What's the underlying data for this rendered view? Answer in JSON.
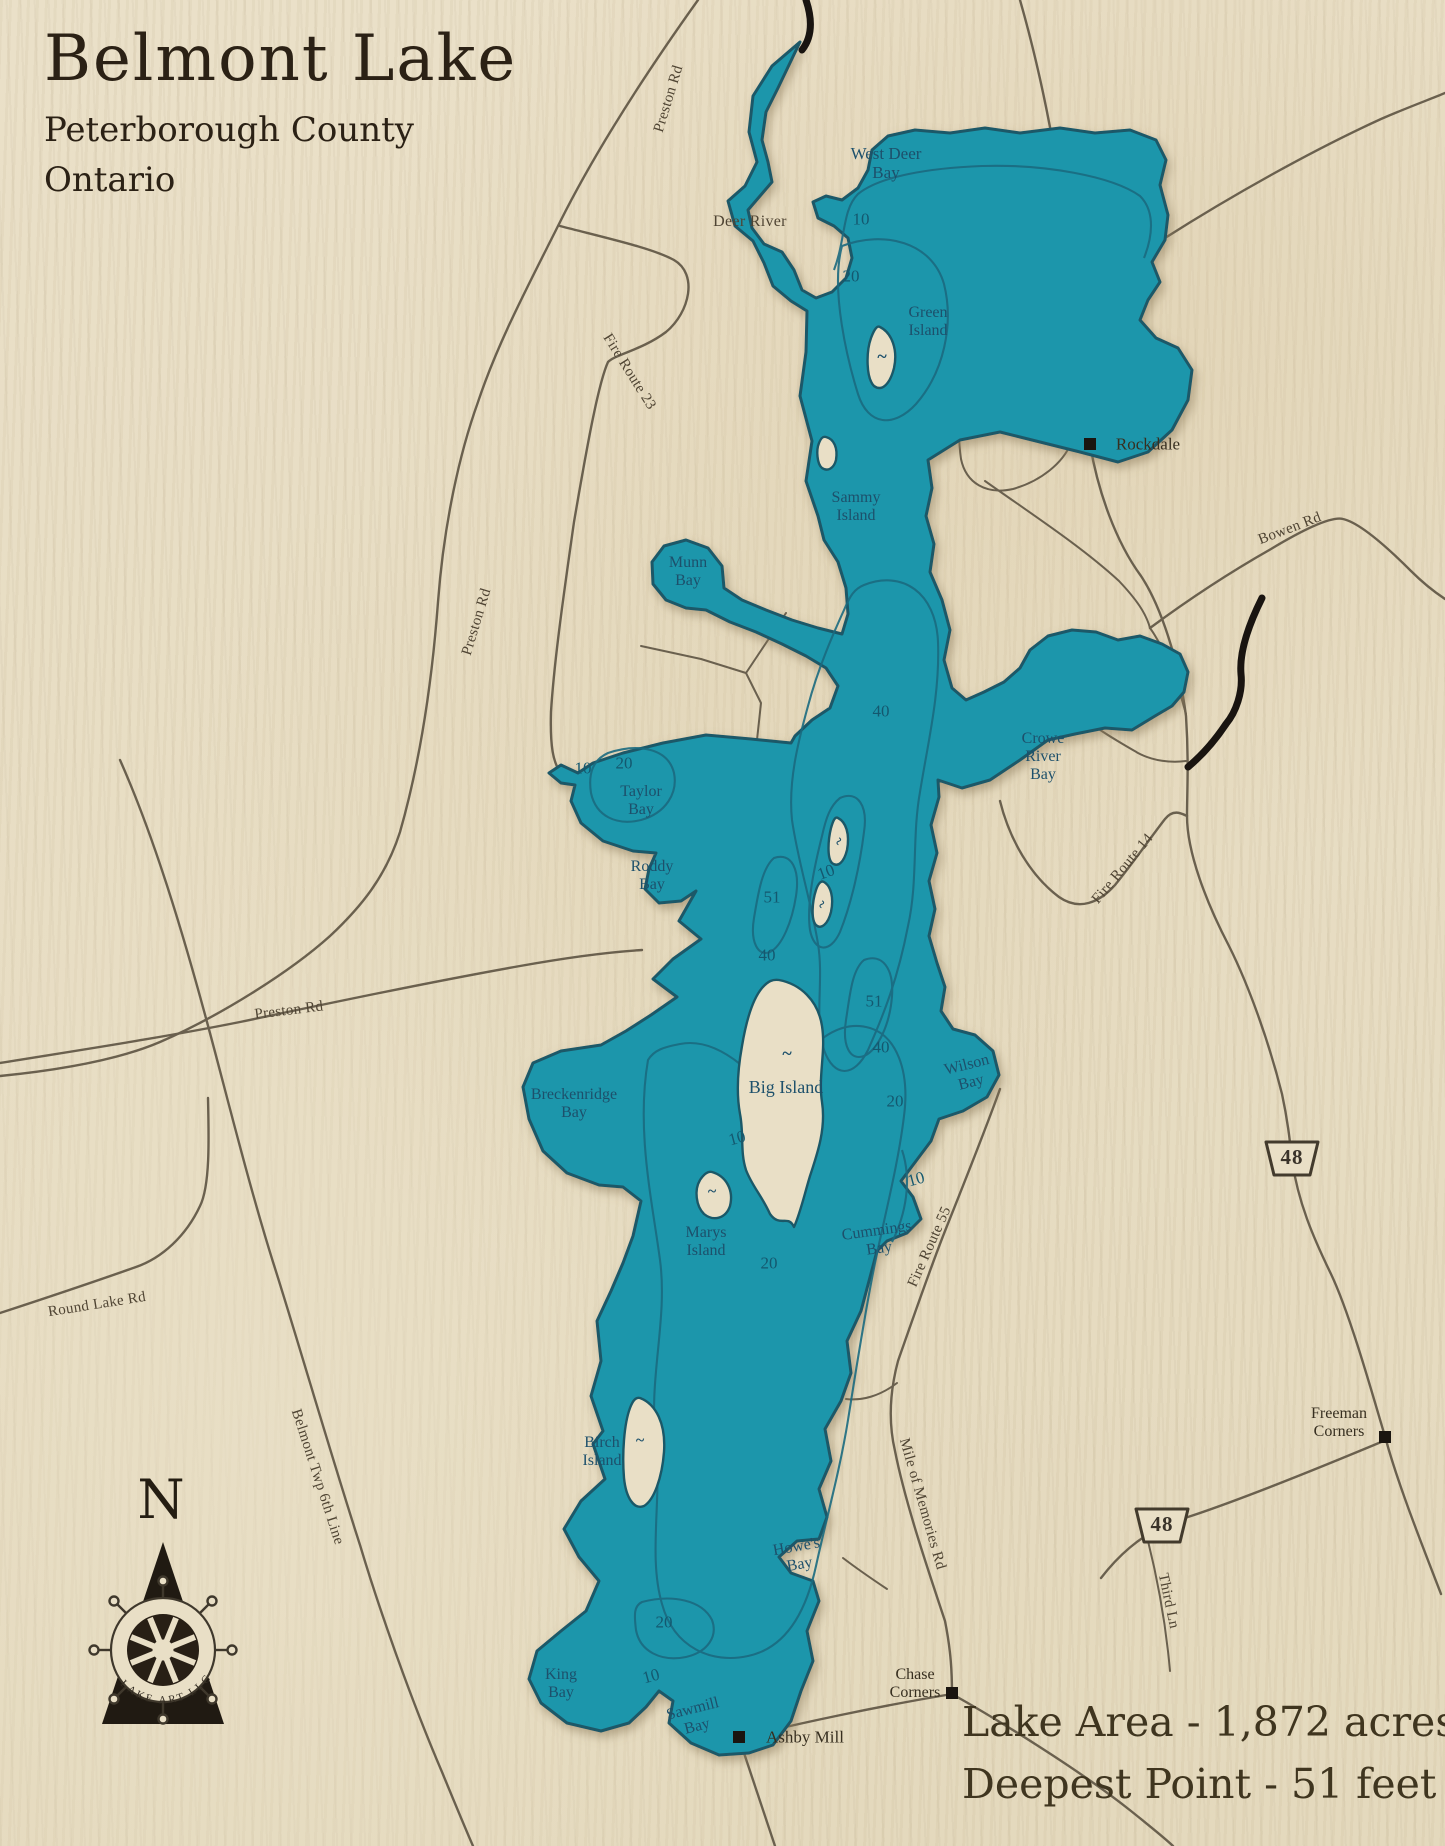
{
  "title": {
    "name": "Belmont Lake",
    "subtitle1": "Peterborough County",
    "subtitle2": "Ontario"
  },
  "stats": {
    "area": "Lake Area - 1,872 acres",
    "depth": "Deepest Point - 51 feet"
  },
  "compass": {
    "north": "N",
    "logo": "LAKE ART LLC"
  },
  "colors": {
    "wood": "#e9dfc6",
    "lake": "#1d96ab",
    "shore": "#1b5868",
    "contour": "#1b6a80",
    "road": "#6a604e",
    "ink": "#2b2115",
    "river_black": "#191410"
  },
  "map_labels": [
    {
      "id": "west-deer-bay",
      "kind": "water",
      "text": "West Deer\nBay",
      "x": 886,
      "y": 163,
      "rot": 0,
      "fs": 17
    },
    {
      "id": "green-island",
      "kind": "water",
      "text": "Green\nIsland",
      "x": 928,
      "y": 322,
      "rot": 0,
      "fs": 16
    },
    {
      "id": "sammy-island",
      "kind": "water",
      "text": "Sammy\nIsland",
      "x": 856,
      "y": 507,
      "rot": 0,
      "fs": 16
    },
    {
      "id": "munn-bay",
      "kind": "water",
      "text": "Munn\nBay",
      "x": 688,
      "y": 572,
      "rot": 0,
      "fs": 16
    },
    {
      "id": "taylor-bay",
      "kind": "water",
      "text": "Taylor\nBay",
      "x": 641,
      "y": 801,
      "rot": 0,
      "fs": 16
    },
    {
      "id": "roddy-bay",
      "kind": "water",
      "text": "Roddy\nBay",
      "x": 652,
      "y": 876,
      "rot": 0,
      "fs": 16
    },
    {
      "id": "crowe-river-bay",
      "kind": "water",
      "text": "Crowe\nRiver\nBay",
      "x": 1043,
      "y": 757,
      "rot": 0,
      "fs": 16
    },
    {
      "id": "wilson-bay",
      "kind": "water",
      "text": "Wilson\nBay",
      "x": 969,
      "y": 1074,
      "rot": -14,
      "fs": 16
    },
    {
      "id": "big-island",
      "kind": "water",
      "text": "Big Island",
      "x": 786,
      "y": 1087,
      "rot": 0,
      "fs": 18
    },
    {
      "id": "breckenridge-bay",
      "kind": "water",
      "text": "Breckenridge\nBay",
      "x": 574,
      "y": 1104,
      "rot": 0,
      "fs": 16
    },
    {
      "id": "marys-island",
      "kind": "water",
      "text": "Marys\nIsland",
      "x": 706,
      "y": 1242,
      "rot": 0,
      "fs": 16
    },
    {
      "id": "cummings-bay",
      "kind": "water",
      "text": "Cummings\nBay",
      "x": 878,
      "y": 1240,
      "rot": -8,
      "fs": 16
    },
    {
      "id": "birch-island",
      "kind": "water",
      "text": "Birch\nIsland",
      "x": 602,
      "y": 1452,
      "rot": 0,
      "fs": 16
    },
    {
      "id": "howes-bay",
      "kind": "water",
      "text": "Howe's\nBay",
      "x": 798,
      "y": 1556,
      "rot": -10,
      "fs": 16
    },
    {
      "id": "king-bay",
      "kind": "water",
      "text": "King\nBay",
      "x": 561,
      "y": 1684,
      "rot": 0,
      "fs": 16
    },
    {
      "id": "sawmill-bay",
      "kind": "water",
      "text": "Sawmill\nBay",
      "x": 695,
      "y": 1718,
      "rot": -14,
      "fs": 16
    },
    {
      "id": "tilde-green-island",
      "kind": "tilde",
      "text": "~",
      "x": 882,
      "y": 356,
      "rot": 0,
      "fs": 18
    },
    {
      "id": "tilde-big-island",
      "kind": "tilde",
      "text": "~",
      "x": 787,
      "y": 1053,
      "rot": 0,
      "fs": 18
    },
    {
      "id": "tilde-marys-island",
      "kind": "tilde",
      "text": "~",
      "x": 712,
      "y": 1192,
      "rot": 0,
      "fs": 16
    },
    {
      "id": "tilde-birch-island",
      "kind": "tilde",
      "text": "~",
      "x": 640,
      "y": 1441,
      "rot": 0,
      "fs": 16
    },
    {
      "id": "tilde-mid-island-a",
      "kind": "tilde",
      "text": "~",
      "x": 840,
      "y": 842,
      "rot": -60,
      "fs": 15
    },
    {
      "id": "tilde-mid-island-b",
      "kind": "tilde",
      "text": "~",
      "x": 823,
      "y": 905,
      "rot": -60,
      "fs": 15
    },
    {
      "id": "depth-10-westdeer",
      "kind": "depth",
      "text": "10",
      "x": 861,
      "y": 219,
      "rot": 0,
      "fs": 17
    },
    {
      "id": "depth-20-north",
      "kind": "depth",
      "text": "20",
      "x": 851,
      "y": 276,
      "rot": 0,
      "fs": 17
    },
    {
      "id": "depth-40-midnorth",
      "kind": "depth",
      "text": "40",
      "x": 881,
      "y": 711,
      "rot": 0,
      "fs": 17
    },
    {
      "id": "depth-20-taylor",
      "kind": "depth",
      "text": "20",
      "x": 624,
      "y": 763,
      "rot": 0,
      "fs": 17
    },
    {
      "id": "depth-10-taylor",
      "kind": "depth",
      "text": "10",
      "x": 583,
      "y": 768,
      "rot": 0,
      "fs": 17
    },
    {
      "id": "depth-51-west",
      "kind": "depth",
      "text": "51",
      "x": 772,
      "y": 897,
      "rot": 0,
      "fs": 17
    },
    {
      "id": "depth-10-islands",
      "kind": "depth",
      "text": "10",
      "x": 826,
      "y": 872,
      "rot": -20,
      "fs": 17
    },
    {
      "id": "depth-40-west",
      "kind": "depth",
      "text": "40",
      "x": 767,
      "y": 955,
      "rot": 0,
      "fs": 17
    },
    {
      "id": "depth-51-southeast",
      "kind": "depth",
      "text": "51",
      "x": 874,
      "y": 1001,
      "rot": 0,
      "fs": 17
    },
    {
      "id": "depth-40-south",
      "kind": "depth",
      "text": "40",
      "x": 881,
      "y": 1047,
      "rot": 0,
      "fs": 17
    },
    {
      "id": "depth-20-wilson",
      "kind": "depth",
      "text": "20",
      "x": 895,
      "y": 1101,
      "rot": 0,
      "fs": 17
    },
    {
      "id": "depth-10-bigisland",
      "kind": "depth",
      "text": "10",
      "x": 737,
      "y": 1138,
      "rot": -15,
      "fs": 17
    },
    {
      "id": "depth-10-cummings",
      "kind": "depth",
      "text": "10",
      "x": 916,
      "y": 1179,
      "rot": -15,
      "fs": 17
    },
    {
      "id": "depth-20-marys",
      "kind": "depth",
      "text": "20",
      "x": 769,
      "y": 1263,
      "rot": 0,
      "fs": 17
    },
    {
      "id": "depth-20-sawmill",
      "kind": "depth",
      "text": "20",
      "x": 664,
      "y": 1622,
      "rot": 0,
      "fs": 17
    },
    {
      "id": "depth-10-king",
      "kind": "depth",
      "text": "10",
      "x": 651,
      "y": 1676,
      "rot": -15,
      "fs": 17
    },
    {
      "id": "deer-river",
      "kind": "road",
      "text": "Deer River",
      "x": 750,
      "y": 222,
      "rot": 0,
      "fs": 16
    },
    {
      "id": "preston-rd-north",
      "kind": "road",
      "text": "Preston Rd",
      "x": 669,
      "y": 99,
      "rot": -73,
      "fs": 15
    },
    {
      "id": "preston-rd-mid",
      "kind": "road",
      "text": "Preston Rd",
      "x": 477,
      "y": 622,
      "rot": -73,
      "fs": 15
    },
    {
      "id": "preston-rd-south",
      "kind": "road",
      "text": "Preston Rd",
      "x": 289,
      "y": 1011,
      "rot": -7,
      "fs": 15
    },
    {
      "id": "fire-route-23",
      "kind": "road",
      "text": "Fire Route 23",
      "x": 629,
      "y": 372,
      "rot": 58,
      "fs": 15
    },
    {
      "id": "bowen-rd",
      "kind": "road",
      "text": "Bowen Rd",
      "x": 1290,
      "y": 529,
      "rot": -21,
      "fs": 15
    },
    {
      "id": "fire-route-14",
      "kind": "road",
      "text": "Fire Route 14",
      "x": 1123,
      "y": 869,
      "rot": -50,
      "fs": 15
    },
    {
      "id": "fire-route-55",
      "kind": "road",
      "text": "Fire Route 55",
      "x": 930,
      "y": 1247,
      "rot": -66,
      "fs": 15
    },
    {
      "id": "mile-of-memories-rd",
      "kind": "road",
      "text": "Mile of Memories Rd",
      "x": 922,
      "y": 1504,
      "rot": 74,
      "fs": 15
    },
    {
      "id": "round-lake-rd",
      "kind": "road",
      "text": "Round Lake Rd",
      "x": 97,
      "y": 1305,
      "rot": -9,
      "fs": 15
    },
    {
      "id": "belmont-twp-6th-line",
      "kind": "road",
      "text": "Belmont Twp 6th Line",
      "x": 317,
      "y": 1477,
      "rot": 72,
      "fs": 15
    },
    {
      "id": "third-ln",
      "kind": "road",
      "text": "Third Ln",
      "x": 1168,
      "y": 1601,
      "rot": 78,
      "fs": 15
    },
    {
      "id": "rockdale",
      "kind": "town",
      "text": "Rockdale",
      "x": 1148,
      "y": 444,
      "rot": 0,
      "fs": 17
    },
    {
      "id": "ashby-mill",
      "kind": "town",
      "text": "Ashby Mill",
      "x": 805,
      "y": 1737,
      "rot": 0,
      "fs": 17
    },
    {
      "id": "chase-corners",
      "kind": "town",
      "text": "Chase\nCorners",
      "x": 915,
      "y": 1684,
      "rot": 0,
      "fs": 16
    },
    {
      "id": "freeman-corners",
      "kind": "town",
      "text": "Freeman\nCorners",
      "x": 1339,
      "y": 1423,
      "rot": 0,
      "fs": 16
    },
    {
      "id": "hwy-48-shield-north",
      "kind": "shield",
      "text": "48",
      "x": 1292,
      "y": 1158,
      "rot": 0,
      "fs": 21
    },
    {
      "id": "hwy-48-shield-south",
      "kind": "shield",
      "text": "48",
      "x": 1162,
      "y": 1525,
      "rot": 0,
      "fs": 21
    },
    {
      "id": "compass-n",
      "kind": "compass",
      "text": "N",
      "x": 161,
      "y": 1500,
      "rot": 0,
      "fs": 54
    }
  ]
}
